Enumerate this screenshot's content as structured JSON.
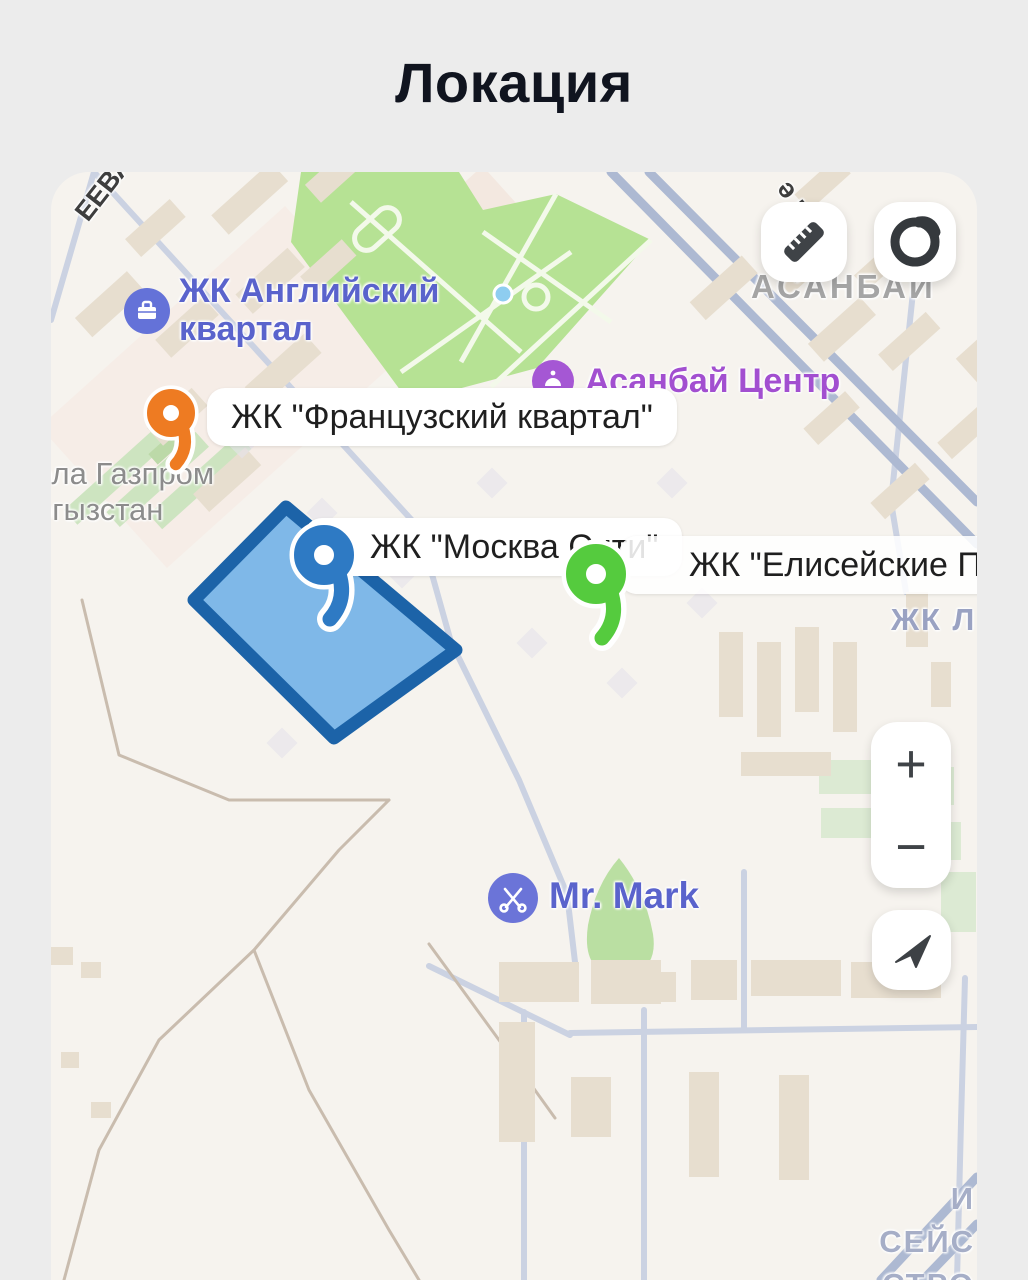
{
  "title": "Локация",
  "map": {
    "streets": {
      "eeva": "ЕЕВА",
      "koch": "ә көч",
      "asanbai_district": "АСАНБАИ",
      "gazprom_line1": "ола Газпром",
      "gazprom_line2": "ргызстан",
      "zhk_l": "ЖК Л",
      "bottom_right_line1": "И",
      "bottom_right_line2": "СЕЙС",
      "bottom_right_line3": "СТРО"
    },
    "pois": {
      "english_quarter_line1": "ЖК Английский",
      "english_quarter_line2": "квартал",
      "asanbai_center": "Асанбай Центр",
      "mr_mark": "Mr. Mark"
    }
  },
  "pins": {
    "french": {
      "label": "ЖК \"Французский квартал\"",
      "color": "#EE7B22"
    },
    "moscow": {
      "label": "ЖК \"Москва Сити\"",
      "color": "#2E7AC4"
    },
    "elysian": {
      "label": "ЖК \"Елисейские По",
      "color": "#55CB3E"
    }
  },
  "polygon": {
    "fill": "#7FB8E8",
    "stroke": "#1C63A8"
  },
  "controls": {
    "zoom_in": "+",
    "zoom_out": "−"
  }
}
